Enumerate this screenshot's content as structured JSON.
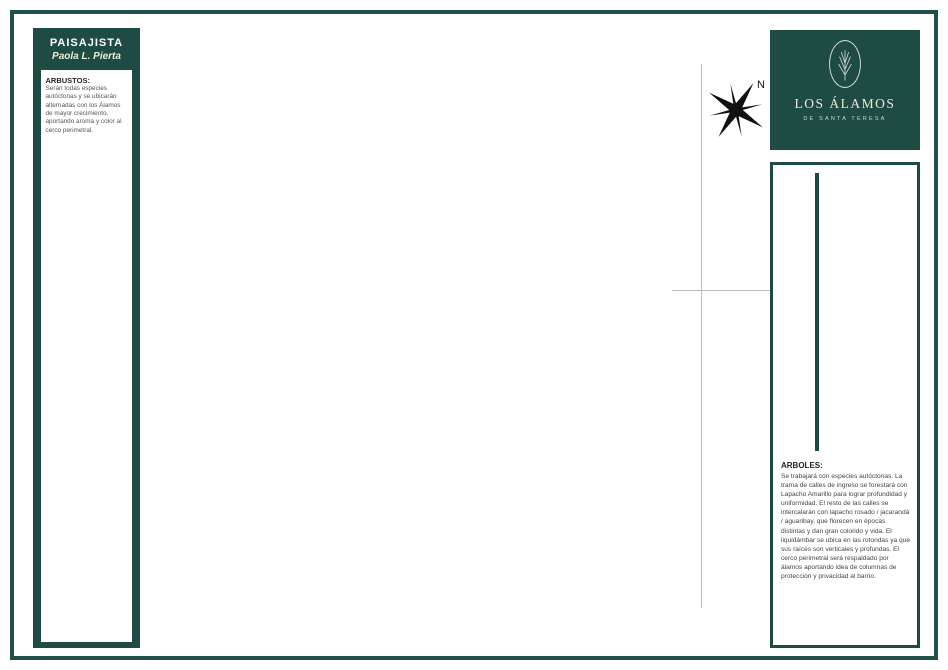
{
  "left_panel": {
    "title": "PAISAJISTA",
    "subtitle": "Paola L. Pierta",
    "shrubs": [
      {
        "name": "Mburucuyá",
        "dot": "#9bc37f",
        "photo": "ph-mburucuya"
      },
      {
        "name": "Lavanda",
        "dot": "#b9aed6",
        "photo": "ph-lavanda"
      },
      {
        "name": "Eugenia",
        "dot": "#d8a8c8",
        "photo": "ph-eugenia"
      },
      {
        "name": "Laurentinas",
        "dot": "#9aa8d8",
        "photo": "ph-laurentinas"
      },
      {
        "name": "Jazmín de leche",
        "dot": "#e6e0b0",
        "photo": "ph-jazmin"
      },
      {
        "name": "Flor de Sangre",
        "dot": "#d87a7a",
        "photo": "ph-florsangre"
      },
      {
        "name": "Bignonia",
        "dot": "#e6d47a",
        "photo": "ph-bignonia"
      },
      {
        "name": "Citronela",
        "dot": "#a8b8c8",
        "photo": "ph-citronela"
      }
    ],
    "arbustos_heading": "ARBUSTOS:",
    "arbustos_text": "Serán todas especies autóctonas y se ubicarán alternadas con los Álamos de mayor crecimiento, aportando aroma y color al cerco perimetral."
  },
  "logo": {
    "title": "LOS ÁLAMOS",
    "subtitle": "DE SANTA TERESA"
  },
  "right_panel": {
    "trees": [
      {
        "name": "Aguaribay",
        "dot": "#7da464",
        "ring": "#527a3a",
        "photo": "ph-aguaribay"
      },
      {
        "name": "Lapacho amarillo",
        "dot": "#ecd98b",
        "ring": "#cdb84f",
        "photo": "ph-amarillo"
      },
      {
        "name": "Lapacho rosado",
        "dot": "#e5b3d8",
        "ring": "#c888b8",
        "photo": "ph-rosado"
      },
      {
        "name": "Jacarandá",
        "dot": "#b3bce3",
        "ring": "#8d98cc",
        "photo": "ph-jacaranda"
      },
      {
        "name": "Álamos",
        "dot": "#8fae6a",
        "ring": "#5d7f45",
        "photo": "ph-alamos"
      },
      {
        "name": "Liquidambar",
        "dot": "#c0503c",
        "ring": "#93392a",
        "photo": "ph-liquidambar"
      }
    ],
    "arboles_heading": "ARBOLES:",
    "arboles_text": "Se trabajará con especies autóctonas. La trama de calles de ingreso se forestará con Lapacho Amarillo para lograr profundidad y uniformidad. El resto de las calles se intercalarán con lapacho rosado / jacarandá / aguaribay, que florecen en épocas distintas y dan gran colorido y vida. El liquidámbar se ubica en las rotondas ya que sus raíces son verticales y profundas. El cerco perimetral será respaldado por álamos aportando idea de columnas de protección y privacidad al barrio."
  },
  "map": {
    "compass_label": "N",
    "laprida_label": "1/2 Calle Laprida (no librada al uso Público)",
    "block_fill": "#a6b486",
    "streets": [
      {
        "name": "Rawson",
        "x": 10,
        "y": 32,
        "w": 628,
        "h": 18,
        "lx": 200,
        "ly": 36,
        "rot": 0
      },
      {
        "name": "",
        "x": 548,
        "y": 14,
        "w": 22,
        "h": 20,
        "lx": 0,
        "ly": 0,
        "rot": 0
      },
      {
        "name": "Amenta",
        "x": 43,
        "y": 50,
        "w": 22,
        "h": 584,
        "lx": 46,
        "ly": 365,
        "rot": -90
      },
      {
        "name": "Colón",
        "x": 5,
        "y": 184,
        "w": 92,
        "h": 18,
        "lx": 18,
        "ly": 188,
        "rot": 0
      },
      {
        "name": "Saenz Peña",
        "x": 5,
        "y": 409,
        "w": 92,
        "h": 18,
        "lx": 11,
        "ly": 413,
        "rot": 0
      },
      {
        "name": "Madero",
        "x": 43,
        "y": 598,
        "w": 595,
        "h": 20,
        "lx": 210,
        "ly": 603,
        "rot": 0
      },
      {
        "name": "",
        "x": 472,
        "y": 618,
        "w": 48,
        "h": 16,
        "lx": 0,
        "ly": 0,
        "rot": 0
      }
    ],
    "species_colors": {
      "aguaribay": {
        "f": "#7ca25c",
        "s": "#527a3a"
      },
      "alamos": {
        "f": "#8fae6a",
        "s": "#5d7f45"
      },
      "amarillo": {
        "f": "#ecd98b",
        "s": "#cdb84f"
      },
      "rosado": {
        "f": "#e5b3d8",
        "s": "#c888b8"
      },
      "jacaranda": {
        "f": "#b3bce3",
        "s": "#8d98cc"
      },
      "liquidambar": {
        "f": "#c0503c",
        "s": "#93392a"
      },
      "gris": {
        "f": "#a9b2a0",
        "s": "#79836f"
      }
    },
    "blocks": [
      {
        "id": "w1",
        "x": 97,
        "y": 58,
        "w": 55,
        "h": 163,
        "rows": [
          [
            "13"
          ],
          [
            "14"
          ],
          [
            "15"
          ],
          [
            "16"
          ],
          [
            "17"
          ]
        ]
      },
      {
        "id": "w2",
        "x": 97,
        "y": 238,
        "w": 55,
        "h": 168,
        "rows": [
          [
            "18"
          ],
          [
            "19"
          ],
          [
            "20"
          ],
          [
            "21"
          ],
          [
            "22"
          ]
        ]
      },
      {
        "id": "w3",
        "x": 97,
        "y": 432,
        "w": 55,
        "h": 163,
        "rows": [
          [
            "23"
          ],
          [
            "24"
          ],
          [
            "25"
          ],
          [
            "26"
          ],
          [
            "27"
          ]
        ]
      },
      {
        "id": "d",
        "x": 172,
        "y": 52,
        "w": 243,
        "h": 74,
        "rows": [
          [
            "12",
            "9",
            "8",
            "5",
            "4",
            "1"
          ],
          [
            "11",
            "10",
            "7",
            "6",
            "3",
            "2"
          ]
        ]
      },
      {
        "id": "e1",
        "x": 172,
        "y": 154,
        "w": 78,
        "h": 240,
        "rows": [
          [
            "118",
            "117"
          ],
          [
            "119",
            "116"
          ],
          [
            "120",
            "115"
          ],
          [
            "121",
            "114"
          ],
          [
            "122",
            "113"
          ],
          [
            "123",
            "112"
          ],
          [
            "124",
            "111"
          ]
        ]
      },
      {
        "id": "e2",
        "x": 268,
        "y": 154,
        "w": 57,
        "h": 240,
        "rows": [
          [
            "104",
            "103"
          ],
          [
            "105",
            "102"
          ],
          [
            "106",
            "101"
          ],
          [
            "107",
            "100"
          ],
          [
            "108",
            "99"
          ],
          [
            "109",
            "98"
          ],
          [
            "110",
            "97"
          ]
        ]
      },
      {
        "id": "e3",
        "x": 355,
        "y": 154,
        "w": 60,
        "h": 240,
        "rows": [
          [
            "90",
            "89"
          ],
          [
            "91",
            "88"
          ],
          [
            "92",
            "87"
          ],
          [
            "93",
            "86"
          ],
          [
            "94",
            "85"
          ],
          [
            "95",
            "84"
          ],
          [
            "96",
            "83"
          ]
        ]
      },
      {
        "id": "f1",
        "x": 445,
        "y": 52,
        "w": 87,
        "h": 219,
        "rows": [
          [
            "61"
          ],
          [
            "60"
          ],
          [
            "59"
          ],
          [
            "62",
            "58"
          ],
          [
            "63",
            "57"
          ],
          [
            "64",
            "56"
          ],
          [
            "65",
            "55"
          ]
        ]
      },
      {
        "id": "f2",
        "x": 445,
        "y": 286,
        "w": 87,
        "h": 180,
        "rows": [
          [
            "66",
            "54"
          ],
          [
            "67",
            "53"
          ],
          [
            "68",
            "52"
          ],
          [
            "69",
            "51"
          ],
          [
            "70",
            "50"
          ],
          [
            "71",
            "49"
          ]
        ]
      },
      {
        "id": "g",
        "x": 172,
        "y": 404,
        "w": 245,
        "h": 62,
        "rows": [
          [
            "77",
            "78",
            "79",
            "80",
            "81",
            "82"
          ],
          [
            "76",
            "75",
            "74",
            "73",
            "72"
          ]
        ]
      },
      {
        "id": "h1",
        "x": 172,
        "y": 489,
        "w": 88,
        "h": 102,
        "rows": [
          [
            "30",
            "31"
          ],
          [
            "29",
            "32"
          ],
          [
            "28",
            "33"
          ]
        ]
      },
      {
        "id": "h2",
        "x": 285,
        "y": 489,
        "w": 80,
        "h": 102,
        "rows": [
          [
            "36",
            "37"
          ],
          [
            "35",
            "38"
          ],
          [
            "34",
            "39"
          ]
        ]
      },
      {
        "id": "h3",
        "x": 388,
        "y": 489,
        "w": 147,
        "h": 102,
        "rows": [
          [
            "42",
            "43",
            "48"
          ],
          [
            "41",
            "44",
            "47"
          ],
          [
            "40",
            "45",
            "46"
          ]
        ]
      }
    ],
    "tree_lines": [
      {
        "x1": 92,
        "y1": 66,
        "x2": 92,
        "y2": 588,
        "n": 26,
        "s": "aguaribay",
        "d": 10
      },
      {
        "x1": 151,
        "y1": 72,
        "x2": 151,
        "y2": 584,
        "n": 23,
        "s": "amarillo"
      },
      {
        "x1": 164,
        "y1": 78,
        "x2": 164,
        "y2": 578,
        "n": 22,
        "s": "amarillo"
      },
      {
        "x1": 182,
        "y1": 53,
        "x2": 528,
        "y2": 53,
        "n": 17,
        "s": "aguaribay"
      },
      {
        "x1": 180,
        "y1": 132,
        "x2": 408,
        "y2": 132,
        "n": 11,
        "s": "aguaribay"
      },
      {
        "x1": 180,
        "y1": 150,
        "x2": 408,
        "y2": 150,
        "n": 11,
        "s": "jacaranda"
      },
      {
        "x1": 254,
        "y1": 162,
        "x2": 254,
        "y2": 384,
        "n": 10,
        "s": "jacaranda"
      },
      {
        "x1": 267,
        "y1": 162,
        "x2": 267,
        "y2": 384,
        "n": 10,
        "s": "rosado"
      },
      {
        "x1": 330,
        "y1": 162,
        "x2": 330,
        "y2": 384,
        "n": 10,
        "s": "rosado"
      },
      {
        "x1": 348,
        "y1": 162,
        "x2": 348,
        "y2": 384,
        "n": 10,
        "s": "jacaranda"
      },
      {
        "x1": 422,
        "y1": 66,
        "x2": 422,
        "y2": 480,
        "n": 19,
        "s": "amarillo"
      },
      {
        "x1": 440,
        "y1": 72,
        "x2": 440,
        "y2": 474,
        "n": 18,
        "s": "amarillo"
      },
      {
        "x1": 554,
        "y1": 66,
        "x2": 554,
        "y2": 586,
        "n": 24,
        "s": "alamos",
        "d": 10
      },
      {
        "x1": 454,
        "y1": 274,
        "x2": 524,
        "y2": 274,
        "n": 5,
        "s": "jacaranda"
      },
      {
        "x1": 454,
        "y1": 285,
        "x2": 524,
        "y2": 285,
        "n": 5,
        "s": "gris"
      },
      {
        "x1": 180,
        "y1": 397,
        "x2": 408,
        "y2": 397,
        "n": 12,
        "s": "aguaribay"
      },
      {
        "x1": 113,
        "y1": 223,
        "x2": 143,
        "y2": 223,
        "n": 3,
        "s": "rosado"
      },
      {
        "x1": 115,
        "y1": 233,
        "x2": 143,
        "y2": 233,
        "n": 3,
        "s": "aguaribay"
      },
      {
        "x1": 113,
        "y1": 422,
        "x2": 143,
        "y2": 422,
        "n": 3,
        "s": "rosado"
      },
      {
        "x1": 115,
        "y1": 431,
        "x2": 143,
        "y2": 431,
        "n": 3,
        "s": "aguaribay"
      },
      {
        "x1": 180,
        "y1": 472,
        "x2": 536,
        "y2": 472,
        "n": 18,
        "s": "rosado"
      },
      {
        "x1": 180,
        "y1": 486,
        "x2": 252,
        "y2": 486,
        "n": 4,
        "s": "gris"
      },
      {
        "x1": 290,
        "y1": 486,
        "x2": 360,
        "y2": 486,
        "n": 4,
        "s": "gris"
      },
      {
        "x1": 396,
        "y1": 486,
        "x2": 460,
        "y2": 486,
        "n": 4,
        "s": "gris"
      },
      {
        "x1": 500,
        "y1": 486,
        "x2": 532,
        "y2": 486,
        "n": 3,
        "s": "gris"
      },
      {
        "x1": 176,
        "y1": 593,
        "x2": 546,
        "y2": 593,
        "n": 18,
        "s": "aguaribay"
      },
      {
        "x1": 373,
        "y1": 502,
        "x2": 373,
        "y2": 584,
        "n": 5,
        "s": "rosado"
      },
      {
        "x1": 385,
        "y1": 502,
        "x2": 385,
        "y2": 584,
        "n": 5,
        "s": "jacaranda"
      }
    ],
    "tree_scatter": [
      {
        "x": 92,
        "y": 238,
        "s": "liquidambar"
      },
      {
        "x": 92,
        "y": 378,
        "s": "liquidambar"
      },
      {
        "x": 92,
        "y": 563,
        "s": "liquidambar"
      },
      {
        "x": 312,
        "y": 53,
        "s": "jacaranda"
      },
      {
        "x": 323,
        "y": 53,
        "s": "jacaranda"
      },
      {
        "x": 330,
        "y": 593,
        "s": "jacaranda"
      },
      {
        "x": 342,
        "y": 593,
        "s": "jacaranda"
      },
      {
        "x": 400,
        "y": 593,
        "s": "jacaranda"
      },
      {
        "x": 259,
        "y": 500,
        "s": "gris"
      },
      {
        "x": 273,
        "y": 500,
        "s": "gris"
      },
      {
        "x": 259,
        "y": 516,
        "s": "gris"
      },
      {
        "x": 274,
        "y": 516,
        "s": "gris"
      },
      {
        "x": 261,
        "y": 533,
        "s": "gris"
      },
      {
        "x": 276,
        "y": 533,
        "s": "gris"
      },
      {
        "x": 472,
        "y": 495,
        "s": "gris"
      },
      {
        "x": 487,
        "y": 495,
        "s": "gris"
      },
      {
        "x": 472,
        "y": 511,
        "s": "gris"
      },
      {
        "x": 488,
        "y": 511,
        "s": "gris"
      },
      {
        "x": 469,
        "y": 527,
        "s": "gris"
      },
      {
        "x": 491,
        "y": 527,
        "s": "gris"
      },
      {
        "x": 472,
        "y": 78,
        "s": "aguaribay"
      },
      {
        "x": 464,
        "y": 104,
        "s": "aguaribay"
      },
      {
        "x": 480,
        "y": 101,
        "s": "aguaribay"
      },
      {
        "x": 496,
        "y": 99,
        "s": "aguaribay"
      },
      {
        "x": 458,
        "y": 128,
        "s": "aguaribay"
      },
      {
        "x": 472,
        "y": 127,
        "s": "aguaribay"
      },
      {
        "x": 487,
        "y": 125,
        "s": "aguaribay"
      },
      {
        "x": 503,
        "y": 125,
        "s": "aguaribay"
      },
      {
        "x": 466,
        "y": 140,
        "s": "aguaribay"
      },
      {
        "x": 450,
        "y": 156,
        "s": "aguaribay"
      },
      {
        "x": 462,
        "y": 155,
        "s": "aguaribay"
      },
      {
        "x": 474,
        "y": 154,
        "s": "aguaribay"
      },
      {
        "x": 487,
        "y": 154,
        "s": "aguaribay"
      },
      {
        "x": 460,
        "y": 172,
        "s": "aguaribay"
      },
      {
        "x": 476,
        "y": 172,
        "s": "aguaribay"
      }
    ],
    "roundabouts": [
      {
        "x": 249,
        "y": 82,
        "r": 15,
        "ring": "aguaribay",
        "center": "liquidambar",
        "stem_to": 50
      },
      {
        "x": 337,
        "y": 82,
        "r": 15,
        "ring": "gris",
        "center": "liquidambar",
        "stem_to": 50
      },
      {
        "x": 250,
        "y": 415,
        "r": 16,
        "ring": "aguaribay",
        "center": "liquidambar",
        "stem_to": 394
      },
      {
        "x": 343,
        "y": 415,
        "r": 16,
        "ring": "aguaribay",
        "center": "liquidambar",
        "stem_to": 394
      },
      {
        "x": 270,
        "y": 551,
        "r": 14,
        "ring": "gris",
        "center": "liquidambar",
        "stem_to": 488
      },
      {
        "x": 480,
        "y": 547,
        "r": 14,
        "ring": "gris",
        "center": "liquidambar",
        "stem_to": 488
      },
      {
        "x": 153,
        "y": 233,
        "r": 11,
        "ring": "none",
        "center": "none",
        "stem_to": -1
      },
      {
        "x": 153,
        "y": 417,
        "r": 11,
        "ring": "none",
        "center": "none",
        "stem_to": -1
      }
    ]
  }
}
